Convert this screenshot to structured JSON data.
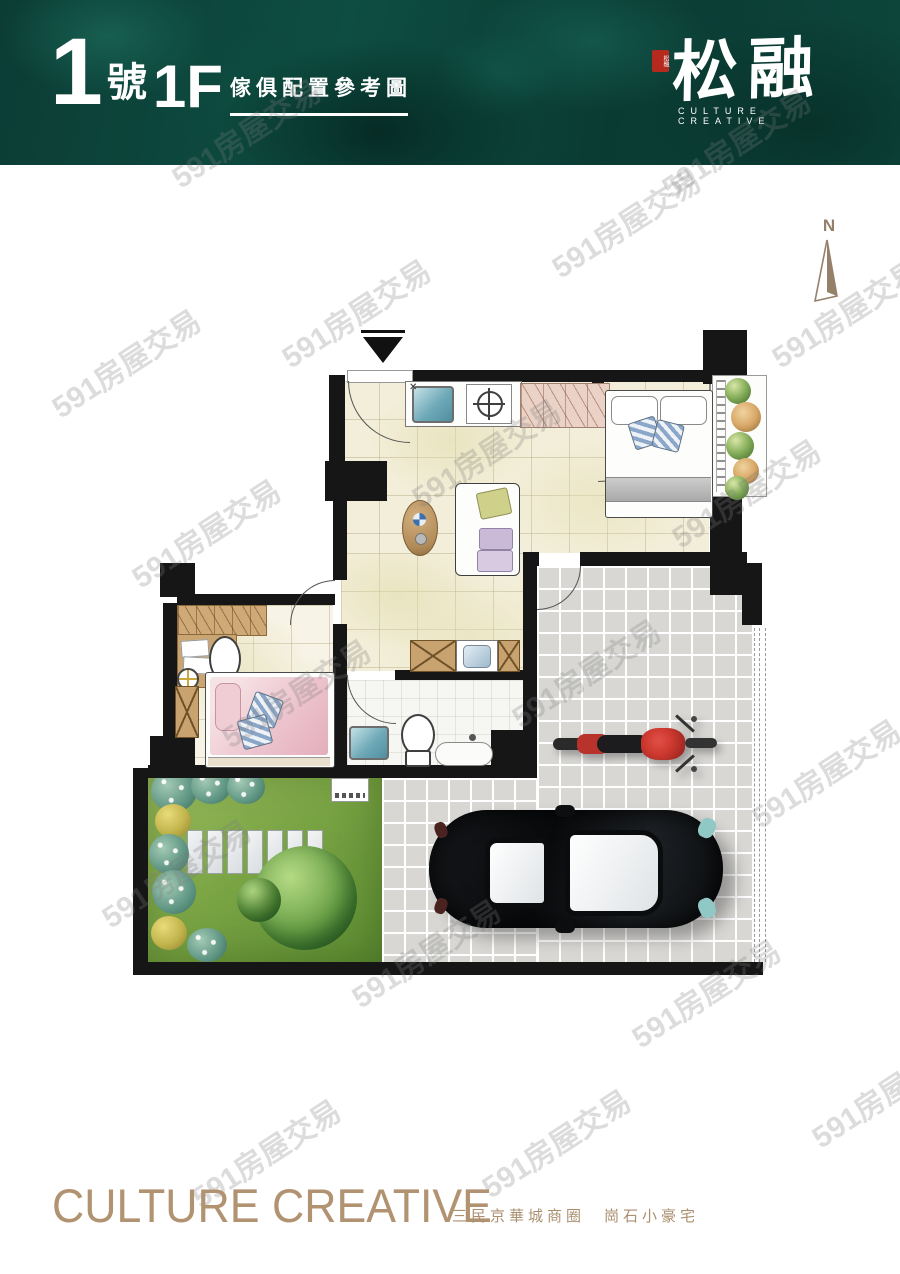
{
  "page": {
    "width": 900,
    "height": 1274,
    "background": "#ffffff"
  },
  "header": {
    "unit_number": "1",
    "unit_suffix": "號",
    "floor_label": "1F",
    "plan_type": "傢俱配置參考圖",
    "bg_color": "#0c453b",
    "logo": {
      "seal_text": "松融",
      "name": "松融",
      "tagline": "CULTURE CREATIVE"
    }
  },
  "compass": {
    "label": "N",
    "color": "#95806a"
  },
  "watermark": {
    "text": "591房屋交易"
  },
  "plan": {
    "wall_color": "#161616",
    "floor_color": "#f3eed9",
    "patio_color": "#d8d7d4",
    "garden_color": "#78a343",
    "bath_color": "#f6f6f3",
    "accent_colors": {
      "sink_teal": "#6fa9b8",
      "bed_pink": "#ecc3cd",
      "car_black": "#121416",
      "motorcycle_red": "#c12d26",
      "wood": "#c8a26f",
      "wardrobe_pink": "#ead2c7"
    },
    "items": [
      {
        "name": "entrance-marker"
      },
      {
        "name": "kitchen-sink"
      },
      {
        "name": "gas-stove"
      },
      {
        "name": "wardrobe"
      },
      {
        "name": "double-bed"
      },
      {
        "name": "balcony-planter"
      },
      {
        "name": "round-table"
      },
      {
        "name": "sofa"
      },
      {
        "name": "vanity-counter"
      },
      {
        "name": "toilet"
      },
      {
        "name": "floor-drain"
      },
      {
        "name": "single-bed"
      },
      {
        "name": "bathroom-sink"
      },
      {
        "name": "bathtub"
      },
      {
        "name": "washing-machine"
      },
      {
        "name": "storage-cabinet"
      },
      {
        "name": "motorcycle"
      },
      {
        "name": "car"
      },
      {
        "name": "garden-tree"
      },
      {
        "name": "stepping-stones"
      },
      {
        "name": "shrubs"
      },
      {
        "name": "property-line"
      },
      {
        "name": "north-arrow"
      }
    ]
  },
  "footer": {
    "title": "CULTURE CREATIVE",
    "subtitle": "三民京華城商圈　崗石小豪宅",
    "color": "#b19372"
  }
}
